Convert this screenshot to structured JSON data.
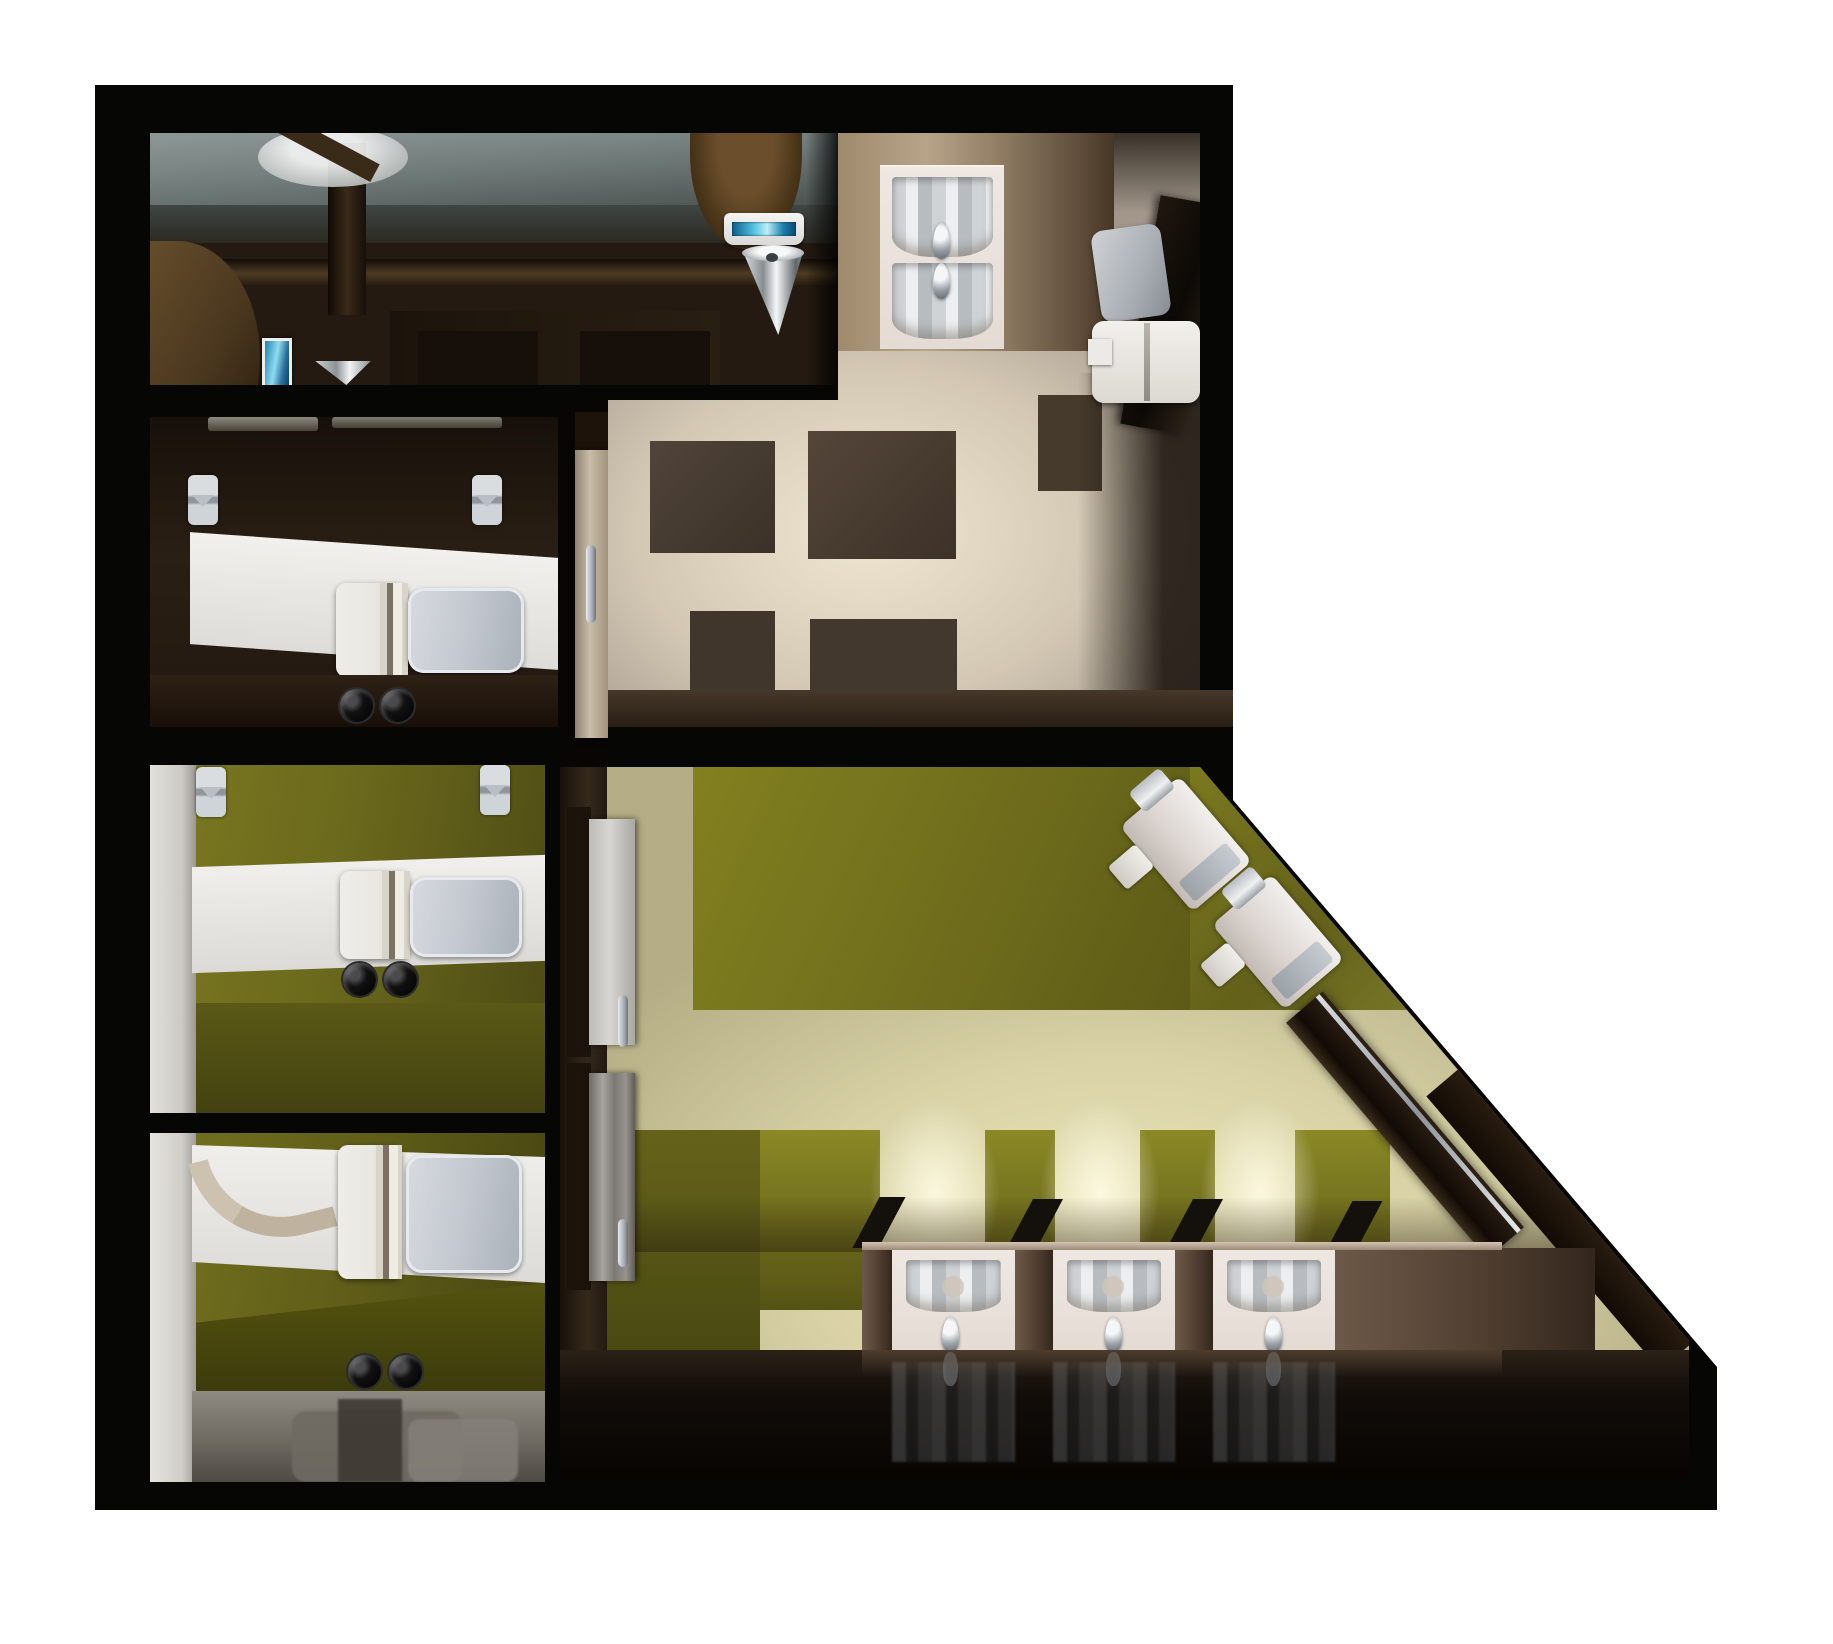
{
  "meta": {
    "title": "Overhead 3D render of a public restroom floor plan",
    "render_type": "architectural-cutaway-top-view",
    "background_color": "#ffffff",
    "visible_text": "none"
  },
  "palette": {
    "outer_wall_black": "#060605",
    "dark_brown_wall": "#241a10",
    "wood_brown": "#5a4228",
    "counter_brown": "#4e3d2f",
    "olive_floor": "#75731d",
    "olive_floor_dark": "#4a4912",
    "cream_floor": "#d8d2a6",
    "corridor_floor_tan": "#d3c8b4",
    "fixture_white": "#e9e7e2",
    "chrome": "#b9bec4",
    "seat_gray": "#c3c8cf",
    "teal_screen": "#3fb0d5",
    "reflective_floor": "#0a0705"
  },
  "rooms": [
    {
      "id": "mech-room",
      "name": "upper-left service room",
      "fixtures": [
        "glass-counter-band",
        "wall-cone-fixture",
        "wood-arch-counter",
        "teal-display-screen",
        "chrome-cone-urinal",
        "hand-dryer",
        "drinking-fountain",
        "dark-tile-floor"
      ]
    },
    {
      "id": "powder-room",
      "name": "upper-right washroom with checkered floor",
      "fixtures": [
        "double-sink-vanity",
        "faucet",
        "faucet",
        "wall-toilet",
        "toilet",
        "leaning-mirror",
        "checkered-floor"
      ]
    },
    {
      "id": "stall-1",
      "name": "dark-brown toilet stall",
      "fixtures": [
        "toilet",
        "toilet-paper-holder",
        "toilet-paper-holder",
        "flush-valve-pair"
      ]
    },
    {
      "id": "stall-2",
      "name": "olive toilet stall",
      "fixtures": [
        "toilet",
        "toilet-paper-holder",
        "toilet-paper-holder",
        "flush-valve-pair"
      ]
    },
    {
      "id": "stall-3",
      "name": "olive accessible stall",
      "fixtures": [
        "toilet",
        "grab-bar",
        "flush-valve-pair",
        "floor-reflection"
      ]
    },
    {
      "id": "vestibule",
      "name": "entry vestibule",
      "fixtures": [
        "entry-door"
      ]
    },
    {
      "id": "main-room",
      "name": "large olive-floored washroom with diagonal wall",
      "fixtures": [
        "stall-door",
        "stall-door",
        "urinal",
        "urinal",
        "leaning-mirror",
        "sink",
        "sink",
        "sink",
        "faucet",
        "faucet",
        "faucet",
        "vanity-counter",
        "reflective-floor"
      ]
    }
  ],
  "fixture_counts": {
    "toilets": 4,
    "wall_urinals": 2,
    "chrome_cone_fixtures": 3,
    "sinks_total": 5,
    "faucets": 5,
    "toilet_paper_holders": 4,
    "grab_bars": 1,
    "doors": 4,
    "leaning_mirrors": 2,
    "hand_dryers": 1,
    "teal_screens": 2,
    "flush_valve_pairs": 3
  },
  "geometry": {
    "building_outline_px": [
      [
        95,
        85
      ],
      [
        1233,
        85
      ],
      [
        1233,
        800
      ],
      [
        1717,
        1367
      ],
      [
        1717,
        1510
      ],
      [
        95,
        1510
      ]
    ],
    "diagonal_wall": "runs from (1233,800) to (1717,1367)",
    "image_size": [
      1833,
      1644
    ]
  }
}
